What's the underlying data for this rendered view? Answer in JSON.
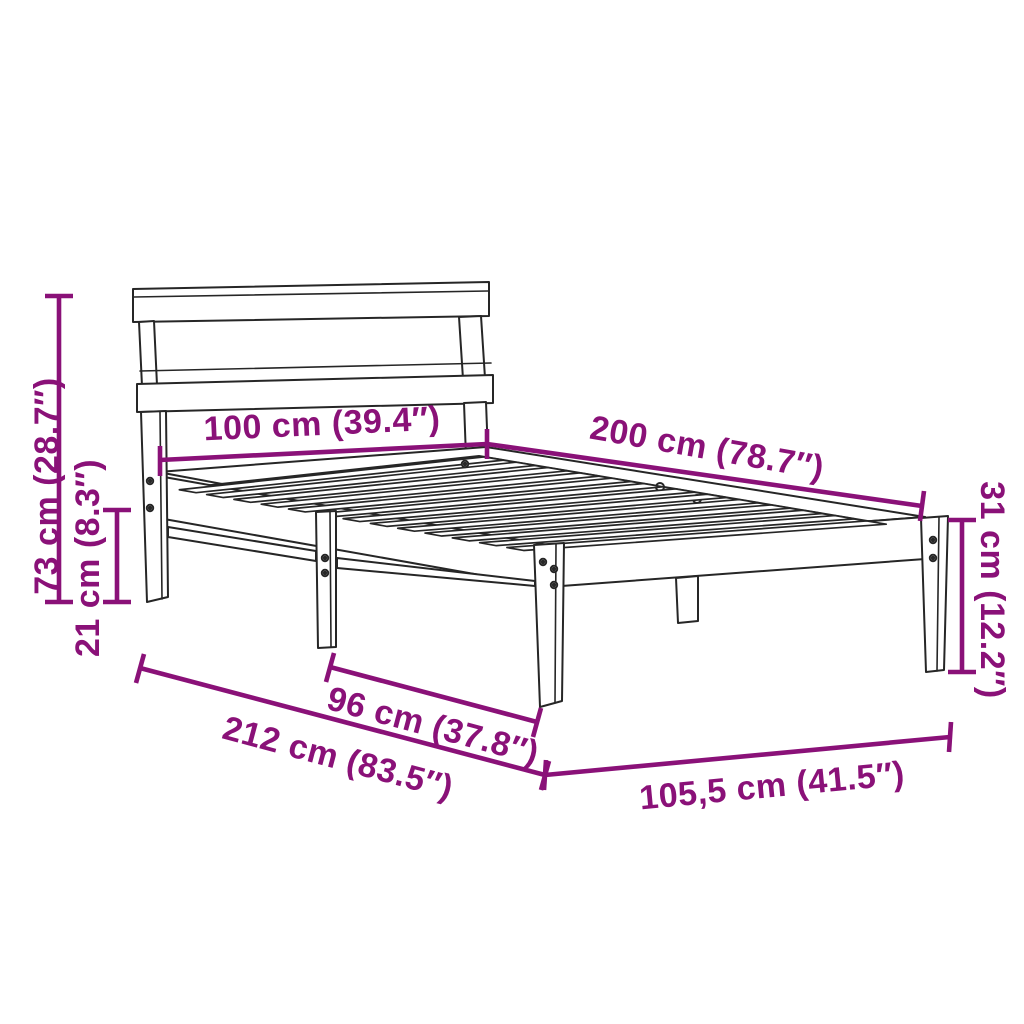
{
  "diagram": {
    "title": "Bed frame dimension diagram",
    "product": "wooden slatted bed frame with headboard",
    "background_color": "#ffffff",
    "outline_color": "#262626",
    "accent_color": "#8a1178",
    "slat_count": 13,
    "dimensions": [
      {
        "name": "overall-height",
        "label": "73 cm (28.7″)"
      },
      {
        "name": "under-bed-clearance",
        "label": "21 cm (8.3″)"
      },
      {
        "name": "headboard-width",
        "label": "100 cm (39.4″)"
      },
      {
        "name": "bed-length",
        "label": "200 cm (78.7″)"
      },
      {
        "name": "side-height",
        "label": "31 cm (12.2″)"
      },
      {
        "name": "leg-spacing",
        "label": "96 cm (37.8″)"
      },
      {
        "name": "overall-length",
        "label": "212 cm (83.5″)"
      },
      {
        "name": "overall-width",
        "label": "105,5 cm (41.5″)"
      }
    ]
  }
}
